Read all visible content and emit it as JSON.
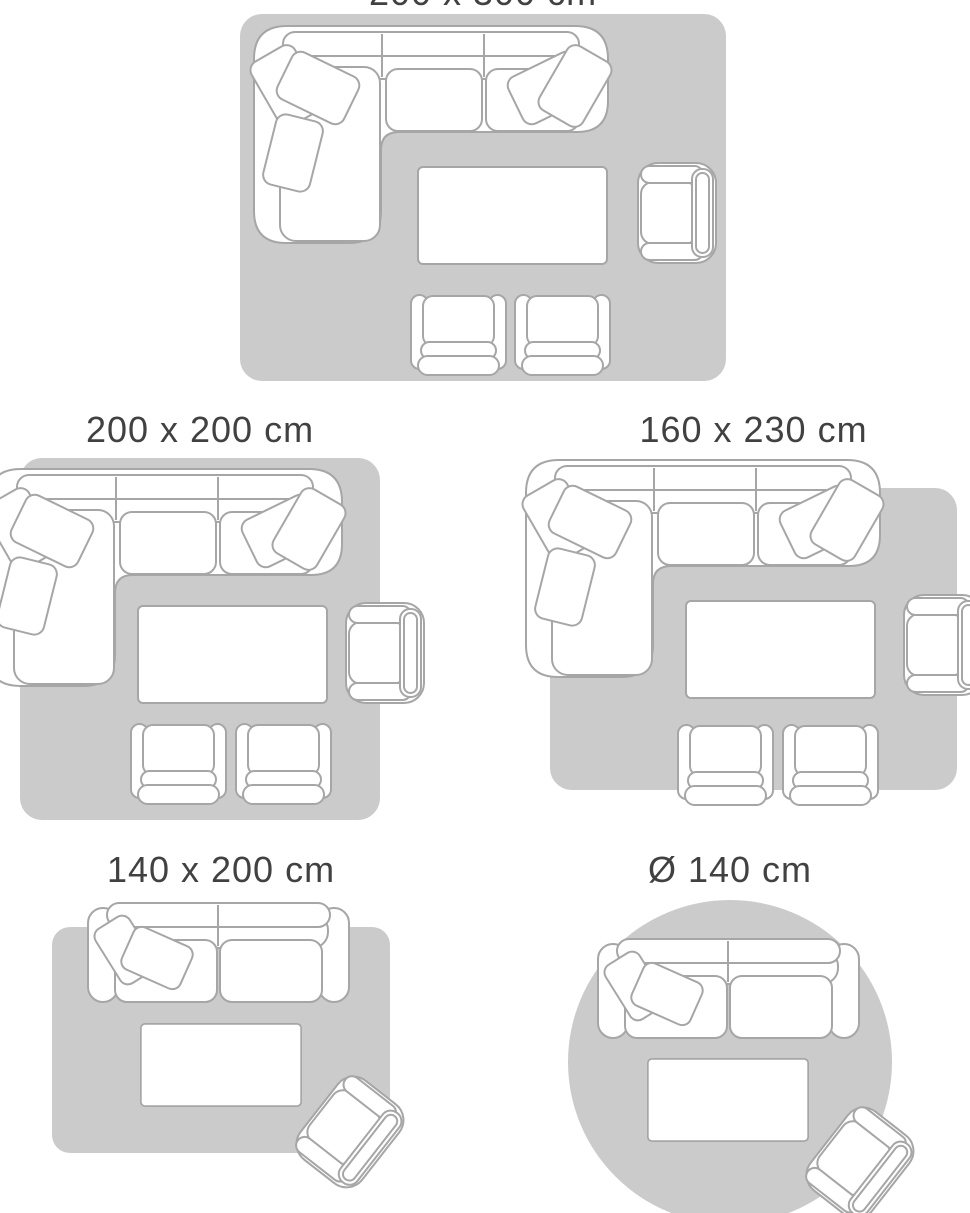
{
  "page": {
    "background_color": "#ffffff",
    "description_colors": {
      "rug_fill": "#cbcbcb",
      "furniture_outline": "#a6a6a6",
      "furniture_fill": "#ffffff",
      "title_text": "#414141"
    }
  },
  "diagrams": [
    {
      "id": "rug-200x300",
      "label": "200 x 300 cm",
      "rug_shape": "rectangle",
      "furniture": [
        "sectional-sofa",
        "coffee-table",
        "armchair",
        "footstool-chair",
        "footstool-chair"
      ]
    },
    {
      "id": "rug-200x200",
      "label": "200 x 200 cm",
      "rug_shape": "square",
      "furniture": [
        "sectional-sofa",
        "coffee-table",
        "armchair",
        "footstool-chair",
        "footstool-chair"
      ]
    },
    {
      "id": "rug-160x230",
      "label": "160 x 230 cm",
      "rug_shape": "rectangle",
      "furniture": [
        "sectional-sofa",
        "coffee-table",
        "armchair",
        "footstool-chair",
        "footstool-chair"
      ]
    },
    {
      "id": "rug-140x200",
      "label": "140 x 200 cm",
      "rug_shape": "rectangle",
      "furniture": [
        "loveseat-sofa",
        "coffee-table",
        "armchair-rotated"
      ]
    },
    {
      "id": "rug-diameter-140",
      "label": "Ø 140 cm",
      "rug_shape": "circle",
      "furniture": [
        "loveseat-sofa",
        "coffee-table",
        "armchair-rotated"
      ]
    }
  ]
}
